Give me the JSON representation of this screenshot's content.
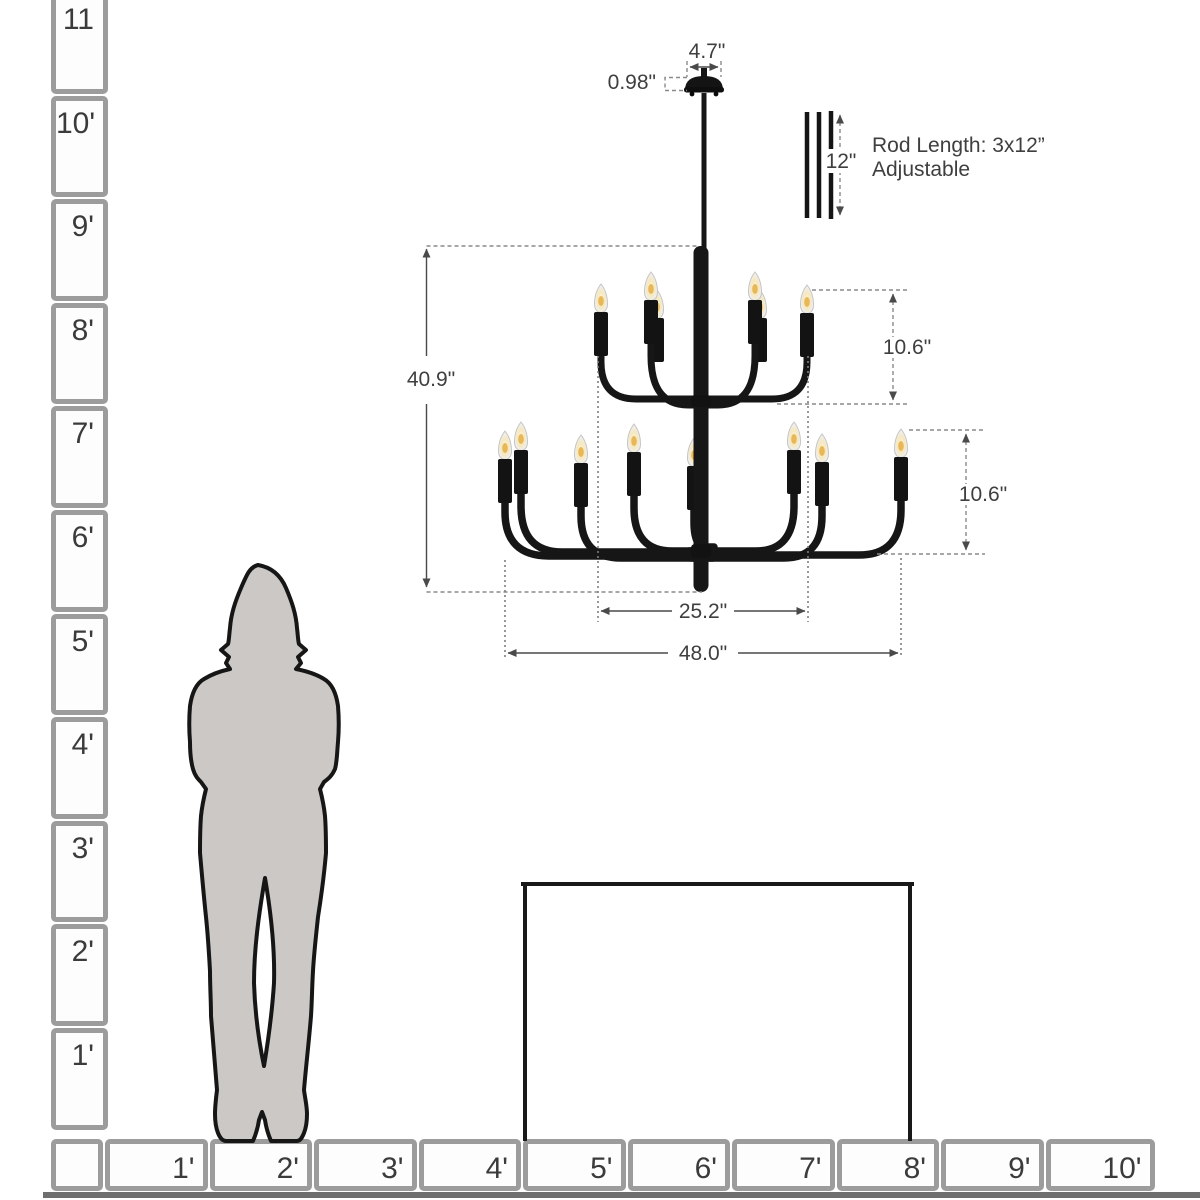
{
  "annotations": {
    "canopy_width": "4.7\"",
    "canopy_height": "0.98\"",
    "rod_segment_length": "12\"",
    "rod_note_line1": "Rod Length: 3x12”",
    "rod_note_line2": "Adjustable",
    "fixture_height": "40.9\"",
    "upper_tier_height": "10.6\"",
    "lower_tier_height": "10.6\"",
    "upper_tier_width": "25.2\"",
    "fixture_width": "48.0\""
  },
  "left_ruler": {
    "unit": "feet",
    "labels": [
      "11",
      "10'",
      "9'",
      "8'",
      "7'",
      "6'",
      "5'",
      "4'",
      "3'",
      "2'",
      "1'"
    ]
  },
  "bottom_ruler": {
    "unit": "feet",
    "labels": [
      "1'",
      "2'",
      "3'",
      "4'",
      "5'",
      "6'",
      "7'",
      "8'",
      "9'",
      "10'"
    ]
  },
  "colors": {
    "fixture_black": "#161616",
    "silhouette_fill": "#cbc8c5",
    "ruler_border": "#9c9c9c",
    "dimension_text": "#3f3f3f",
    "bulb_glow": "#e8b44f"
  }
}
